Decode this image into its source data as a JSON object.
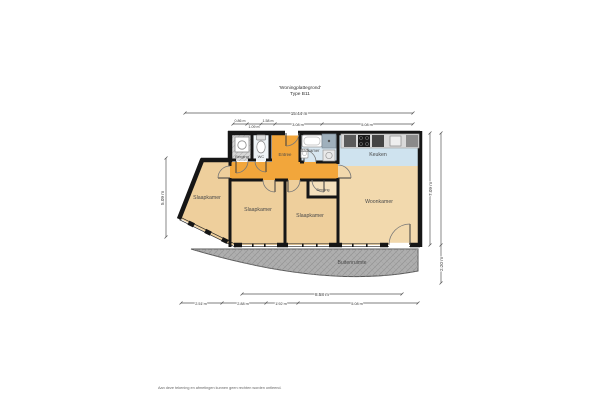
{
  "title": {
    "line1": "'Woningplattegrond'",
    "line2": "Type B11"
  },
  "rooms": {
    "storage_top": "Berging",
    "wc": "WC",
    "entree": "Entree",
    "badkamer": "Badkamer",
    "keuken": "Keuken",
    "slaapkamer_left": "Slaapkamer",
    "slaapkamer_mid1": "Slaapkamer",
    "slaapkamer_mid2": "Slaapkamer",
    "storage_small": "Berging",
    "woonkamer": "Woonkamer",
    "balkon": "Buitenruimte"
  },
  "dimensions": {
    "total_width": "15.44 m",
    "top_segments": [
      "0.86 m",
      "1.09 m",
      "1.58 m",
      "3.08 m",
      "5.08 m"
    ],
    "balcony_width": "8.58 m",
    "bottom_segments": [
      "2.51 m",
      "2.88 m",
      "1.92 m",
      "5.08 m"
    ],
    "left_height": "5.09 m",
    "right_height": "7.09 m",
    "balcony_depth": "2.20 m"
  },
  "footer": {
    "disclaimer": "Aan deze tekening en afmetingen kunnen geen rechten worden ontleend."
  },
  "colors": {
    "wall": "#161616",
    "floor_bedroom": "#eecf9c",
    "floor_living": "#f2d9ad",
    "floor_hall": "#f2a63b",
    "floor_wet": "#d8e7f1",
    "floor_kitchen": "#cfe3ef",
    "floor_storage": "#d7d7d7",
    "floor_balcony": "#aeaeae"
  }
}
